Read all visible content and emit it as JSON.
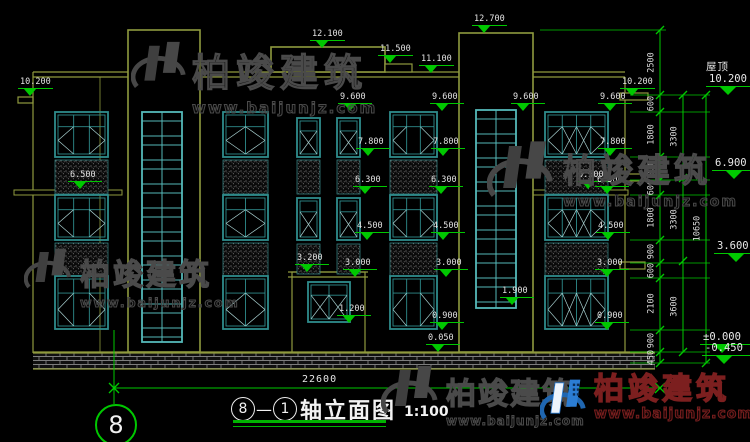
{
  "drawing": {
    "title": {
      "axis_from": "8",
      "dash": "—",
      "axis_to": "1",
      "text": "轴立面图",
      "scale": "1:100"
    },
    "axis_bubble": "8",
    "bottom_dim": "22600",
    "porch_dim": "4520",
    "colors": {
      "outline": "#8f9a3e",
      "dim_green": "#00c800",
      "window": "#2f8c8c",
      "window_bright": "#55b9b9",
      "text": "#e6e6e6",
      "brand_blue": "#2b7dd4",
      "brand_red": "#7c1f1f"
    },
    "elevation_markers": [
      {
        "label": "10.200",
        "value": 10.2,
        "x": 18
      },
      {
        "label": "12.100",
        "value": 12.1,
        "x": 310
      },
      {
        "label": "11.500",
        "value": 11.5,
        "x": 378
      },
      {
        "label": "11.100",
        "value": 11.1,
        "x": 419
      },
      {
        "label": "12.700",
        "value": 12.7,
        "x": 472
      },
      {
        "label": "10.200",
        "value": 10.2,
        "x": 620
      },
      {
        "label": "9.600",
        "value": 9.6,
        "x": 338
      },
      {
        "label": "9.600",
        "value": 9.6,
        "x": 430
      },
      {
        "label": "9.600",
        "value": 9.6,
        "x": 511
      },
      {
        "label": "9.600",
        "value": 9.6,
        "x": 598
      },
      {
        "label": "7.800",
        "value": 7.8,
        "x": 356
      },
      {
        "label": "7.800",
        "value": 7.8,
        "x": 431
      },
      {
        "label": "7.800",
        "value": 7.8,
        "x": 598
      },
      {
        "label": "6.500",
        "value": 6.5,
        "x": 68
      },
      {
        "label": "6.500",
        "value": 6.5,
        "x": 576
      },
      {
        "label": "6.300",
        "value": 6.3,
        "x": 353
      },
      {
        "label": "6.300",
        "value": 6.3,
        "x": 429
      },
      {
        "label": "6.300",
        "value": 6.3,
        "x": 595
      },
      {
        "label": "4.500",
        "value": 4.5,
        "x": 355
      },
      {
        "label": "4.500",
        "value": 4.5,
        "x": 431
      },
      {
        "label": "4.500",
        "value": 4.5,
        "x": 596
      },
      {
        "label": "3.200",
        "value": 3.2,
        "x": 295
      },
      {
        "label": "3.000",
        "value": 3.0,
        "x": 343
      },
      {
        "label": "3.000",
        "value": 3.0,
        "x": 434
      },
      {
        "label": "3.000",
        "value": 3.0,
        "x": 595
      },
      {
        "label": "1.900",
        "value": 1.9,
        "x": 500
      },
      {
        "label": "1.200",
        "value": 1.2,
        "x": 337
      },
      {
        "label": "0.900",
        "value": 0.9,
        "x": 430
      },
      {
        "label": "0.900",
        "value": 0.9,
        "x": 595
      },
      {
        "label": "0.050",
        "value": 0.05,
        "x": 426
      }
    ],
    "outer_markers": [
      {
        "top": "屋顶",
        "label": "10.200",
        "value": 10.2,
        "x": 706
      },
      {
        "top": "",
        "label": "6.900",
        "value": 6.9,
        "x": 712
      },
      {
        "top": "",
        "label": "3.600",
        "value": 3.6,
        "x": 714
      },
      {
        "top": "",
        "label": "±0.000",
        "value": 0,
        "x": 700
      },
      {
        "top": "",
        "label": "-0.450",
        "value": -0.45,
        "x": 702
      }
    ],
    "dim_chains": [
      {
        "x": 660,
        "segments": [
          [
            "2500",
            30,
            95
          ],
          [
            "600",
            95,
            112
          ],
          [
            "1800",
            112,
            157
          ],
          [
            "900",
            157,
            180
          ],
          [
            "600",
            180,
            195
          ],
          [
            "1800",
            195,
            240
          ],
          [
            "900",
            240,
            263
          ],
          [
            "600",
            263,
            278
          ],
          [
            "2100",
            278,
            330
          ],
          [
            "900",
            330,
            352
          ],
          [
            "450",
            352,
            363
          ]
        ]
      },
      {
        "x": 683,
        "segments": [
          [
            "3300",
            95,
            178
          ],
          [
            "3300",
            178,
            261
          ],
          [
            "3600",
            261,
            352
          ]
        ]
      },
      {
        "x": 706,
        "segments": [
          [
            "10650",
            95,
            363
          ]
        ]
      }
    ]
  },
  "watermark": {
    "name": "柏竣建筑",
    "url": "www.baijunjz.com"
  },
  "brand": {
    "name": "柏竣建筑",
    "url": "www.baijunjz.com"
  }
}
